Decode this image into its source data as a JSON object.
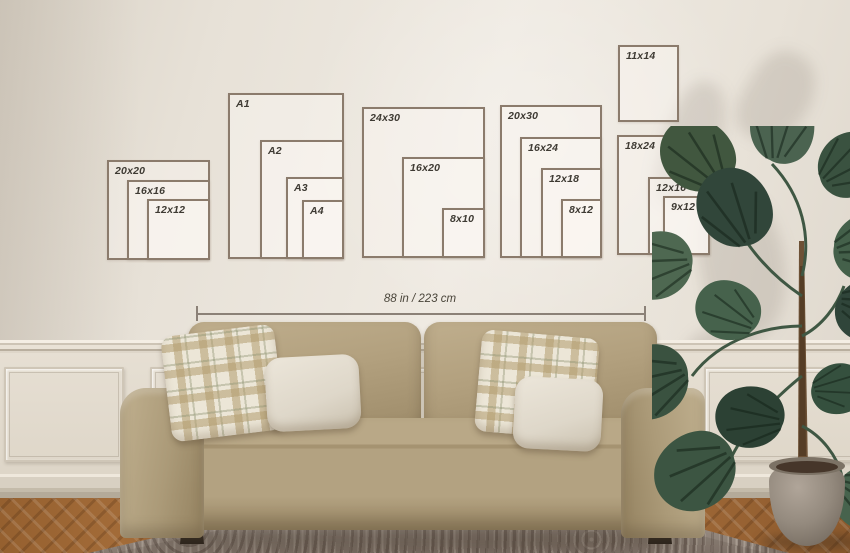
{
  "size_chart": {
    "line_color": "#8b7b6c",
    "label_color": "#3e3a33",
    "groups": [
      {
        "name": "square-sizes",
        "boxes": [
          {
            "label": "20x20",
            "x": 107,
            "y": 160,
            "w": 103,
            "h": 100
          },
          {
            "label": "16x16",
            "x": 127,
            "y": 180,
            "w": 83,
            "h": 80
          },
          {
            "label": "12x12",
            "x": 147,
            "y": 199,
            "w": 63,
            "h": 61
          }
        ]
      },
      {
        "name": "a-series",
        "boxes": [
          {
            "label": "A1",
            "x": 228,
            "y": 93,
            "w": 116,
            "h": 166
          },
          {
            "label": "A2",
            "x": 260,
            "y": 140,
            "w": 84,
            "h": 119
          },
          {
            "label": "A3",
            "x": 286,
            "y": 177,
            "w": 58,
            "h": 82
          },
          {
            "label": "A4",
            "x": 302,
            "y": 200,
            "w": 42,
            "h": 59
          }
        ]
      },
      {
        "name": "24x30-family",
        "boxes": [
          {
            "label": "24x30",
            "x": 362,
            "y": 107,
            "w": 123,
            "h": 151
          },
          {
            "label": "16x20",
            "x": 402,
            "y": 157,
            "w": 83,
            "h": 101
          },
          {
            "label": "8x10",
            "x": 442,
            "y": 208,
            "w": 43,
            "h": 50
          }
        ]
      },
      {
        "name": "20x30-family",
        "boxes": [
          {
            "label": "20x30",
            "x": 500,
            "y": 105,
            "w": 102,
            "h": 153
          },
          {
            "label": "16x24",
            "x": 520,
            "y": 137,
            "w": 82,
            "h": 121
          },
          {
            "label": "12x18",
            "x": 541,
            "y": 168,
            "w": 61,
            "h": 90
          },
          {
            "label": "8x12",
            "x": 561,
            "y": 199,
            "w": 41,
            "h": 59
          }
        ]
      },
      {
        "name": "11x14-single",
        "boxes": [
          {
            "label": "11x14",
            "x": 618,
            "y": 45,
            "w": 61,
            "h": 77
          }
        ]
      },
      {
        "name": "18x24-family",
        "boxes": [
          {
            "label": "18x24",
            "x": 617,
            "y": 135,
            "w": 93,
            "h": 120
          },
          {
            "label": "12x16",
            "x": 648,
            "y": 177,
            "w": 62,
            "h": 78
          },
          {
            "label": "9x12",
            "x": 663,
            "y": 196,
            "w": 47,
            "h": 59
          }
        ]
      }
    ]
  },
  "measurement": {
    "label": "88 in / 223 cm",
    "x1": 196,
    "x2": 644,
    "y": 313
  }
}
